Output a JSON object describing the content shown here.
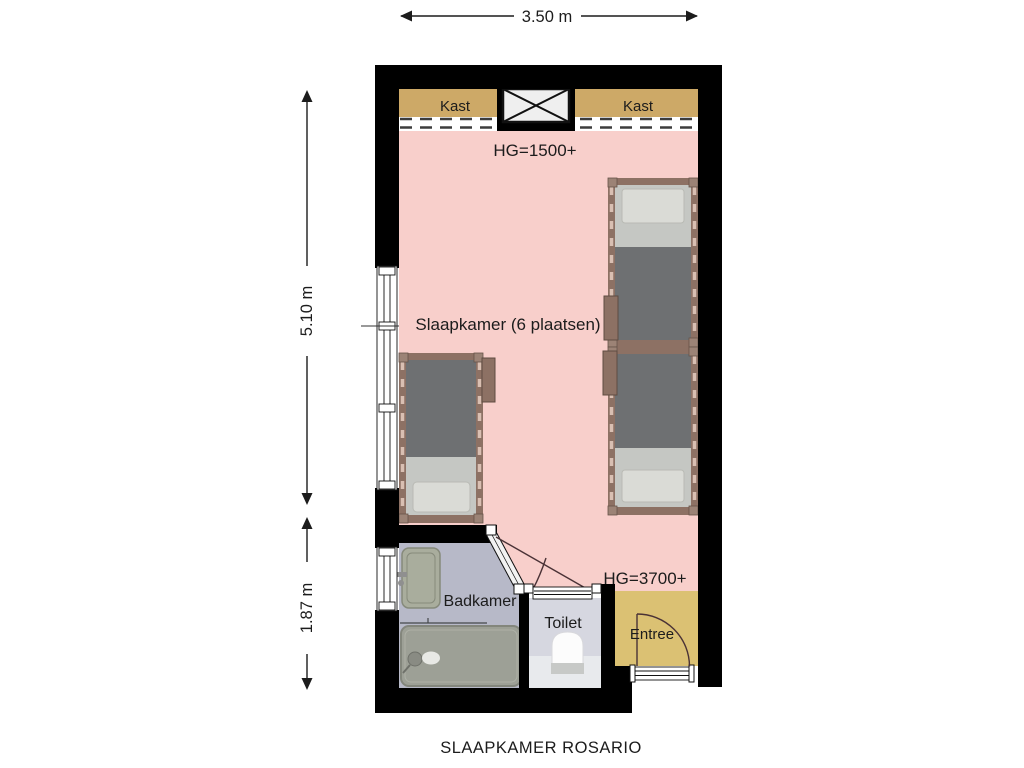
{
  "title": "SLAAPKAMER ROSARIO",
  "dimensions": {
    "width": "3.50 m",
    "height_upper": "5.10 m",
    "height_lower": "1.87 m"
  },
  "labels": {
    "closet_left": "Kast",
    "closet_right": "Kast",
    "hg_top": "HG=1500+",
    "bedroom": "Slaapkamer (6 plaatsen)",
    "hg_bottom": "HG=3700+",
    "bathroom": "Badkamer",
    "toilet": "Toilet",
    "entry": "Entree"
  },
  "colors": {
    "wall": "#000000",
    "bedroom_floor": "#f8cfcb",
    "closet": "#cda967",
    "closet_strip": "#ffffff",
    "shaft_box": "#efefef",
    "entry_floor": "#dbc173",
    "bathroom_floor": "#b7b9c8",
    "toilet_floor": "#d6d7e0",
    "toilet_floor_light": "#e8eaed",
    "bathtub": "#9da096",
    "sink": "#a9ad9d",
    "bed_frame": "#8d7164",
    "bed_blanket": "#6e7072",
    "bed_sheet": "#c5c7c3",
    "bed_pillow": "#dadbd6",
    "door_swing": "#4a3236",
    "dimension_text": "#1c1c1c"
  }
}
